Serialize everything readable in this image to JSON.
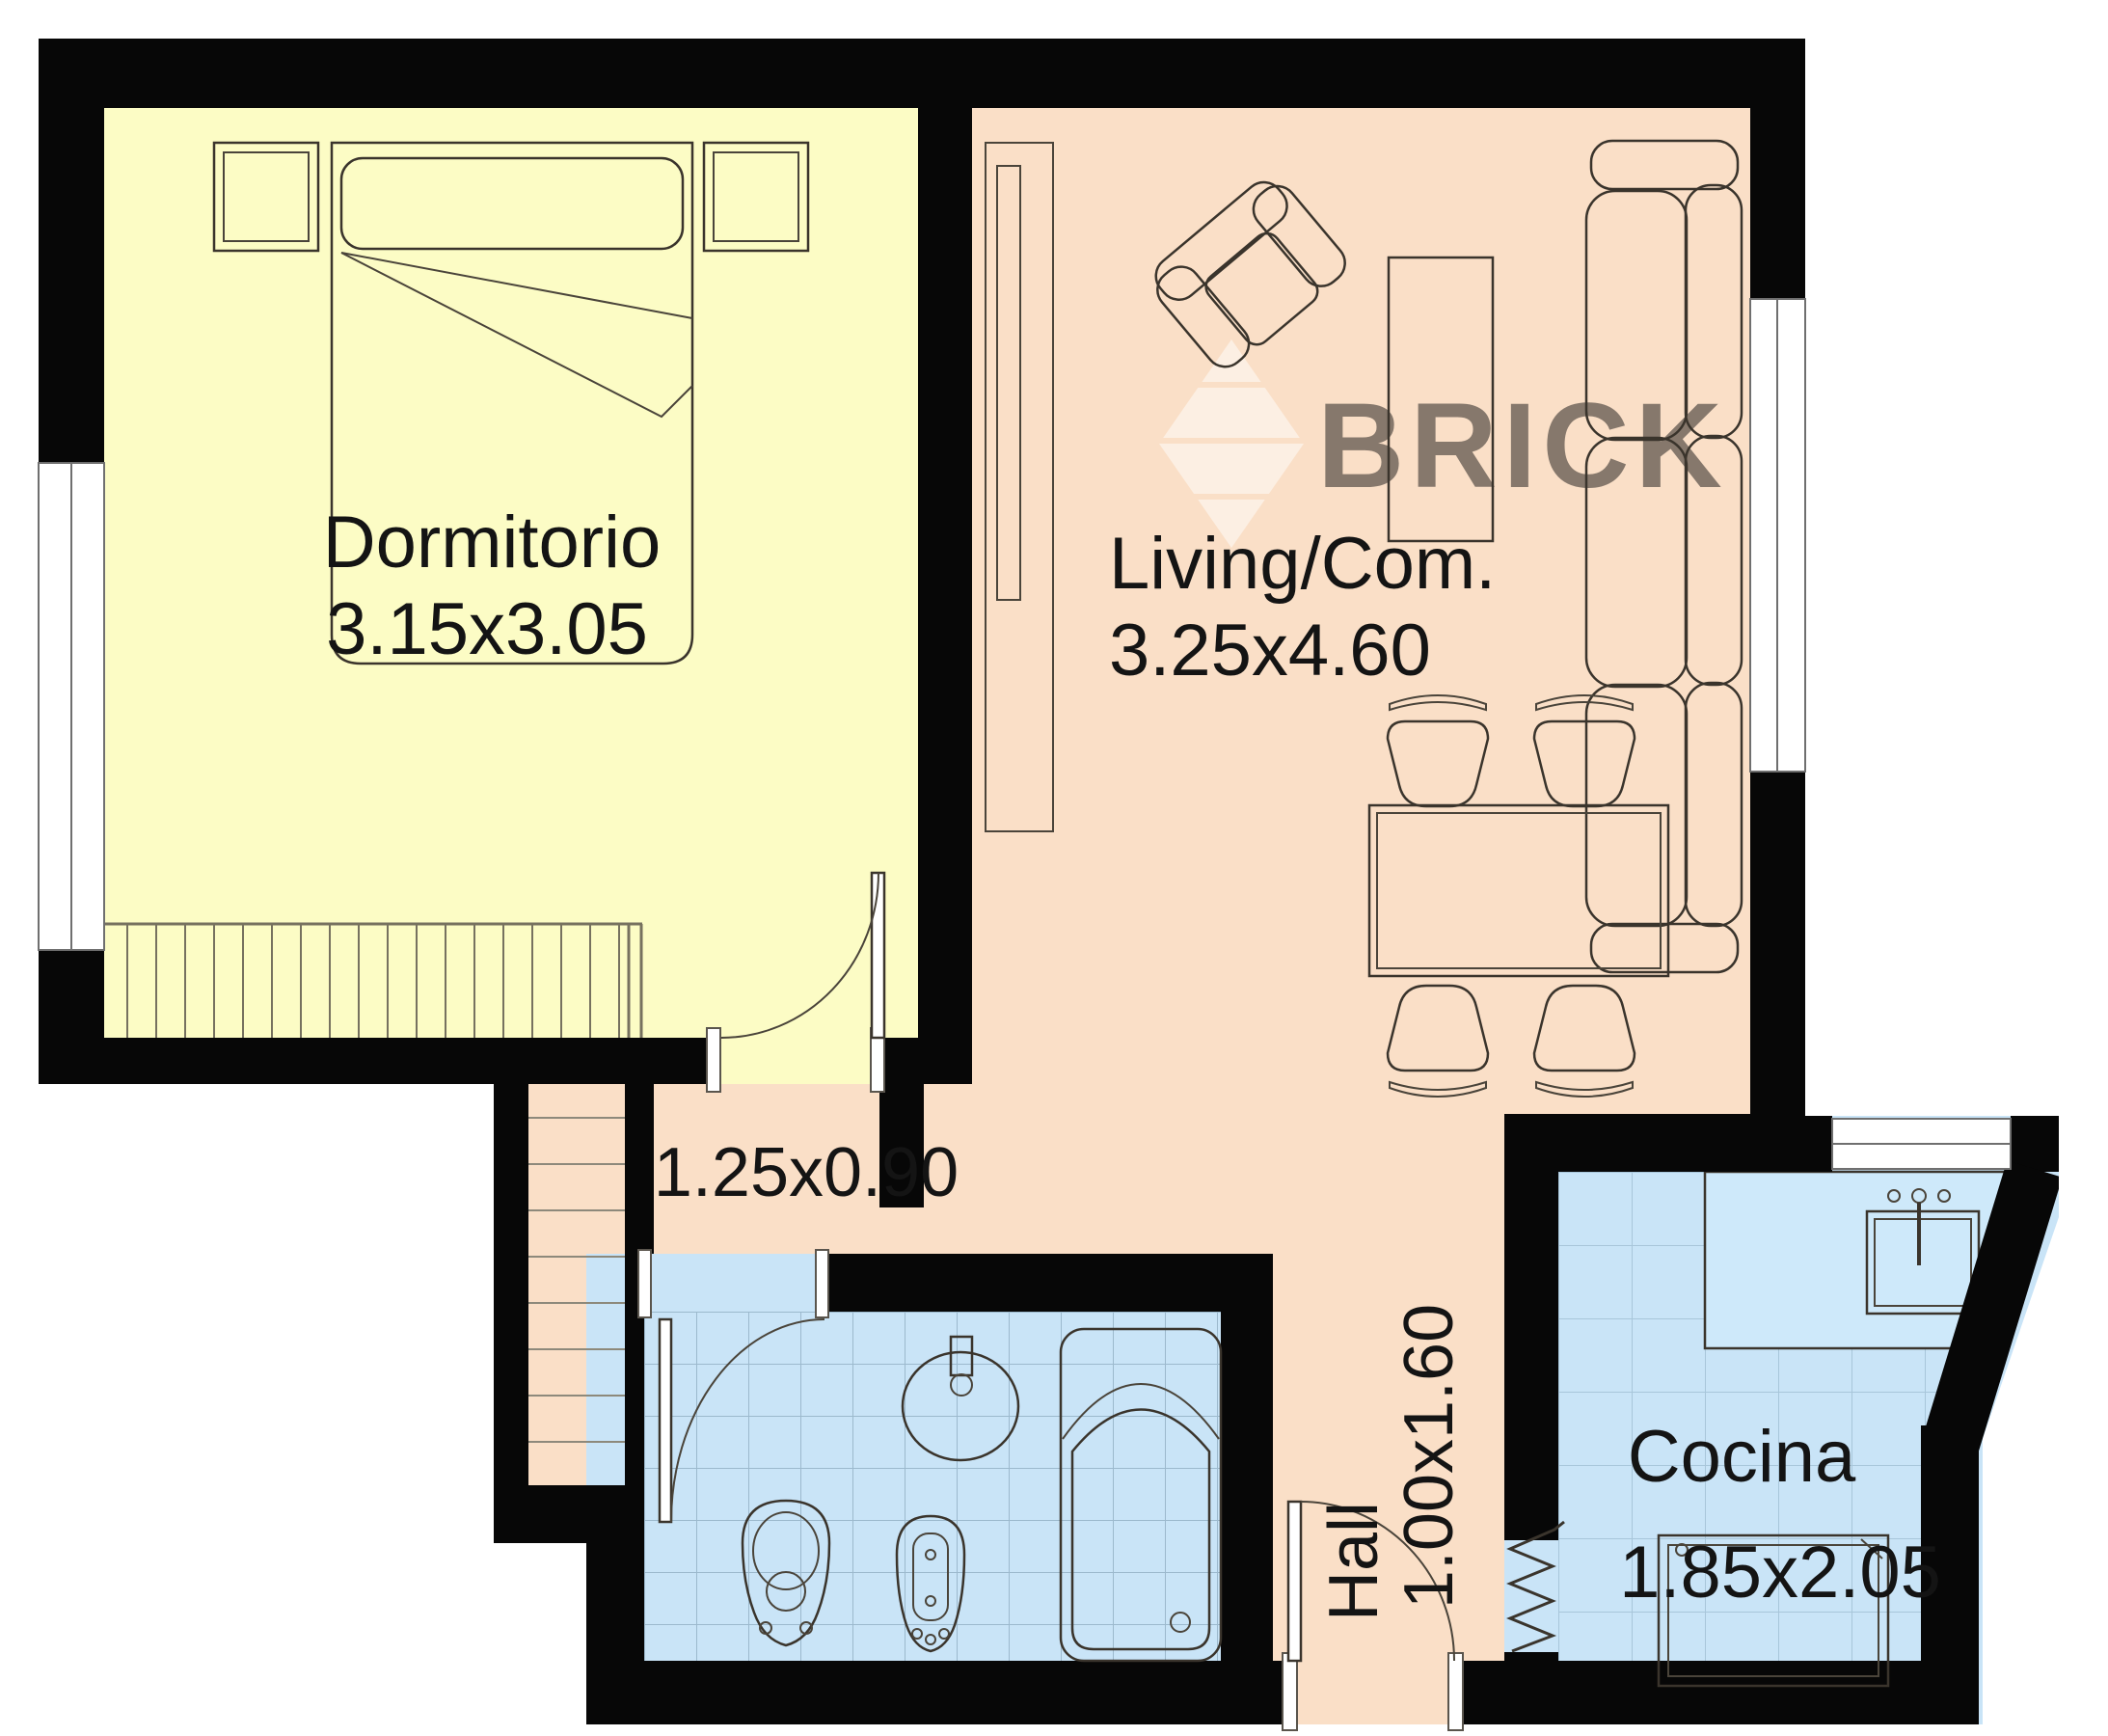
{
  "title": "Apartment floor plan",
  "watermark": {
    "brand": "BRICK",
    "color": "#ffffff"
  },
  "rooms": {
    "dormitorio": {
      "label": "Dormitorio",
      "dims": "3.15x3.05",
      "color": "#fcfcc5"
    },
    "living": {
      "label": "Living/Com.",
      "dims": "3.25x4.60",
      "color": "#fadfc7"
    },
    "hall": {
      "label": "Hall",
      "dims": "1.00x1.60",
      "color": "#fadfc7"
    },
    "cocina": {
      "label": "Cocina",
      "dims": "1.85x2.05",
      "color": "#c9e4f7"
    },
    "bano": {
      "color": "#c9e4f7"
    },
    "pasillo": {
      "dims": "1.25x0.90"
    },
    "escalera": {
      "color": "#fadfc7"
    }
  },
  "colors": {
    "wall": "#070707",
    "background": "#ffffff",
    "tile_line_bath": "#9cb9cd",
    "tile_line_kitchen": "#a8c6da",
    "stair_line": "#8d897b",
    "closet_line": "#76715f",
    "counter_fill": "#cee9fa",
    "text": "#141414"
  }
}
